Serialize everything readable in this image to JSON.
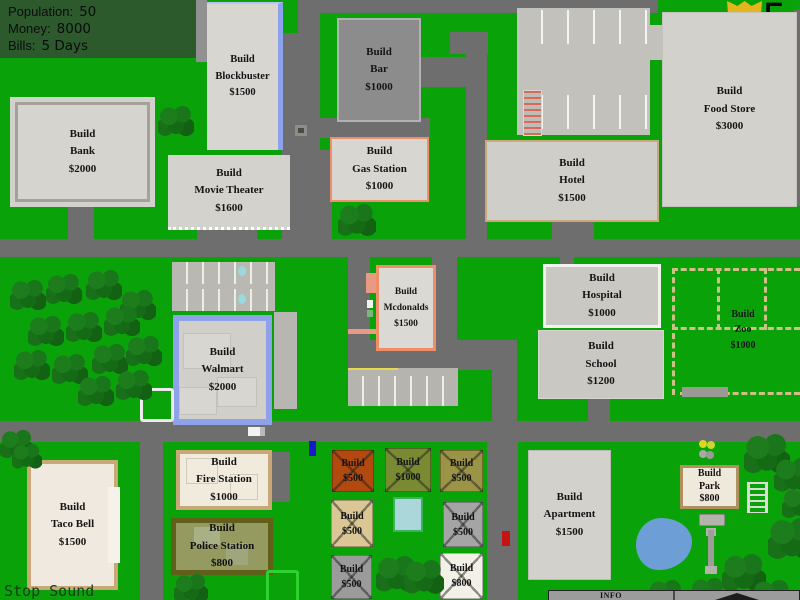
{
  "hud": {
    "population_label": "Population:",
    "population_value": "50",
    "money_label": "Money:",
    "money_value": "8000",
    "bills_label": "Bills:",
    "bills_value": "5 Days"
  },
  "day_badge": {
    "bonus_top": "+5",
    "bonus_bottom": "STR",
    "day": "5"
  },
  "controls": {
    "stop_sound": "Stop Sound",
    "info": "INFO"
  },
  "buildings": {
    "bank": {
      "action": "Build",
      "name": "Bank",
      "price": "$2000"
    },
    "blockbuster": {
      "action": "Build",
      "name": "Blockbuster",
      "price": "$1500"
    },
    "movie_theater": {
      "action": "Build",
      "name": "Movie Theater",
      "price": "$1600"
    },
    "bar": {
      "action": "Build",
      "name": "Bar",
      "price": "$1000"
    },
    "gas_station": {
      "action": "Build",
      "name": "Gas Station",
      "price": "$1000"
    },
    "food_store": {
      "action": "Build",
      "name": "Food Store",
      "price": "$3000"
    },
    "hotel": {
      "action": "Build",
      "name": "Hotel",
      "price": "$1500"
    },
    "mcdonalds": {
      "action": "Build",
      "name": "Mcdonalds",
      "price": "$1500"
    },
    "walmart": {
      "action": "Build",
      "name": "Walmart",
      "price": "$2000"
    },
    "hospital": {
      "action": "Build",
      "name": "Hospital",
      "price": "$1000"
    },
    "school": {
      "action": "Build",
      "name": "School",
      "price": "$1200"
    },
    "zoo": {
      "action": "Build",
      "name": "Zoo",
      "price": "$1000"
    },
    "taco_bell": {
      "action": "Build",
      "name": "Taco Bell",
      "price": "$1500"
    },
    "fire_station": {
      "action": "Build",
      "name": "Fire Station",
      "price": "$1000"
    },
    "police_station": {
      "action": "Build",
      "name": "Police Station",
      "price": "$800"
    },
    "apartment": {
      "action": "Build",
      "name": "Apartment",
      "price": "$1500"
    },
    "park": {
      "action": "Build",
      "name": "Park",
      "price": "$800"
    }
  },
  "plots": {
    "p1": {
      "action": "Build",
      "price": "$500"
    },
    "p2": {
      "action": "Build",
      "price": "$1000"
    },
    "p3": {
      "action": "Build",
      "price": "$500"
    },
    "p4": {
      "action": "Build",
      "price": "$500"
    },
    "p5": {
      "action": "Build",
      "price": "$500"
    },
    "p6": {
      "action": "Build",
      "price": "$500"
    },
    "p7": {
      "action": "Build",
      "price": "$800"
    }
  },
  "colors": {
    "grass": "#09a309",
    "road": "#6e6e6e",
    "hud_panel": "#2d5a2d",
    "badge_gold": "#e6b51c",
    "gas_border": "#ee8e6a",
    "walmart_border": "#8ea2e9",
    "tan_border": "#c9a878",
    "police_border": "#60601a",
    "pond_blue": "#6d9fd6"
  }
}
